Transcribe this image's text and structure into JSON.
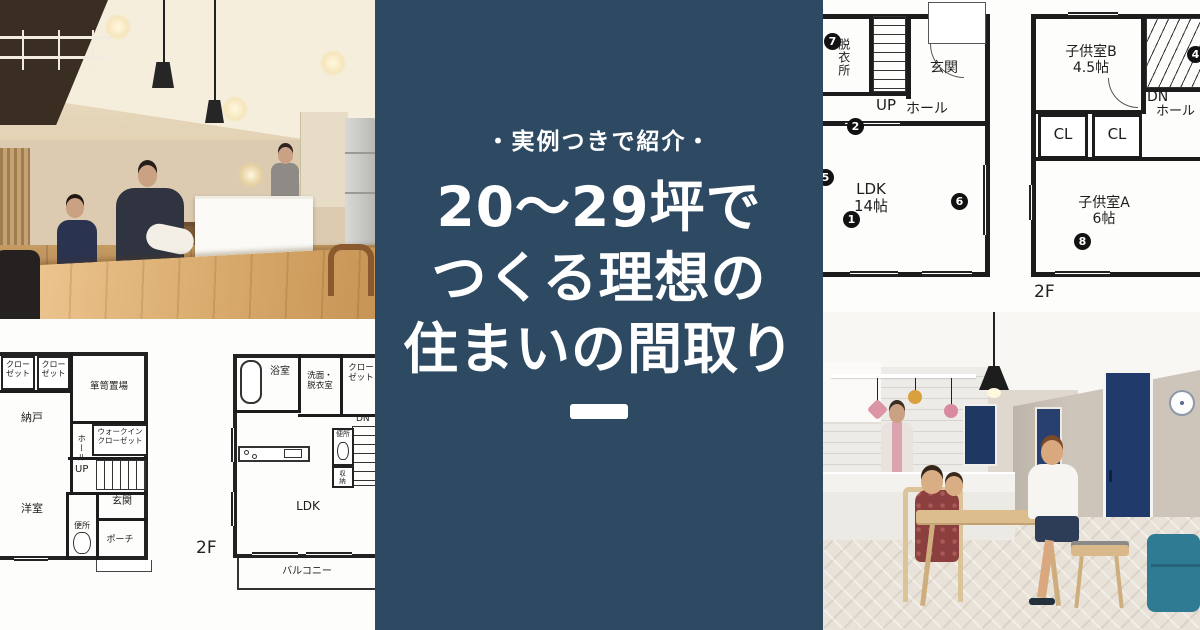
{
  "overlay": {
    "tagline": "・実例つきで紹介・",
    "title_lines": [
      "20〜29坪で",
      "つくる理想の",
      "住まいの間取り"
    ],
    "colors": {
      "band_navy": "#2e4a63",
      "text_white": "#ffffff"
    }
  },
  "floorplan_1f_right": {
    "washroom_vertical": "脱衣所",
    "stairs_up": "UP",
    "entrance": "玄関",
    "hall": "ホール",
    "ldk": "LDK\n14帖",
    "markers": [
      "7",
      "2",
      "5",
      "1",
      "6"
    ]
  },
  "floorplan_2f_right": {
    "kids_room_b": "子供室B\n4.5帖",
    "stairs_dn": "DN",
    "hall": "ホール",
    "closet1": "CL",
    "closet2": "CL",
    "kids_room_a": "子供室A\n6帖",
    "markers": [
      "4",
      "8"
    ],
    "floor_label": "2F"
  },
  "floorplan_1f_left": {
    "closet1": "クロー\nゼット",
    "closet2": "クロー\nゼット",
    "tansu_storage": "箪笥置場",
    "storage_room": "納戸",
    "hall_vertical": "ホール",
    "walk_in_closet": "ウォークイン\nクローゼット",
    "stairs_up": "UP",
    "western_room": "洋室",
    "entrance": "玄関",
    "toilet": "便所",
    "porch": "ポーチ"
  },
  "floorplan_2f_left": {
    "bath": "浴室",
    "washroom": "洗面・\n脱衣室",
    "closet": "クロー\nゼット",
    "stairs_dn": "DN",
    "toilet": "便所",
    "storage_vertical": "収納",
    "ldk": "LDK",
    "balcony": "バルコニー",
    "floor_label": "2F"
  },
  "photo_colors": {
    "navy_door": "#203a6b",
    "teal_sofa": "#2f7b93",
    "wood_table": "#d7a96b"
  }
}
